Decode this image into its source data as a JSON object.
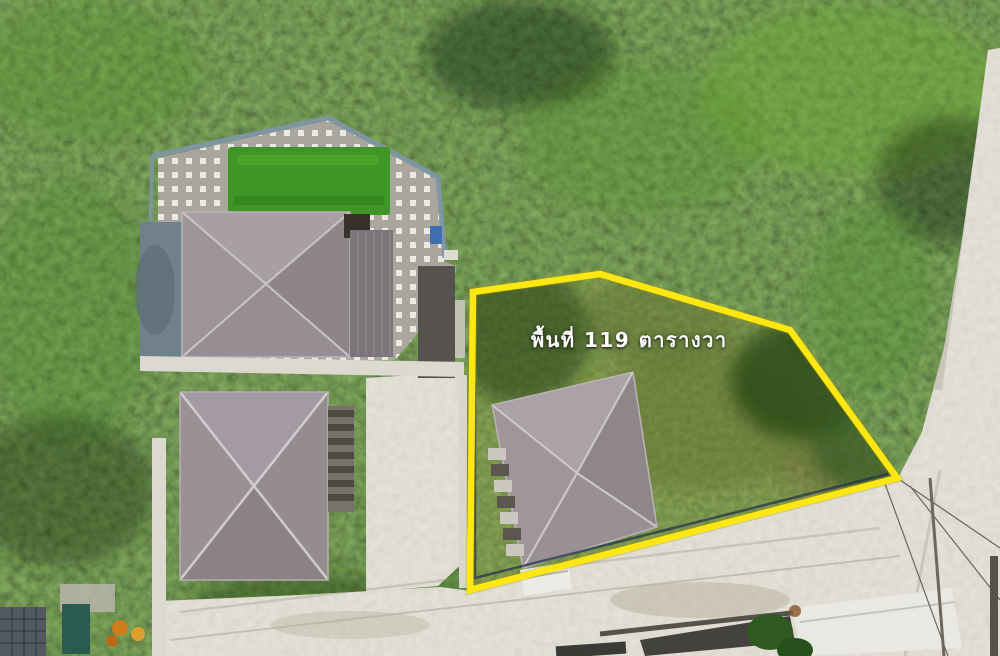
{
  "annotation": {
    "area_label": "พื้นที่ 119 ตารางวา",
    "text_color": "#ffffff"
  },
  "plot_boundary": {
    "points": "600,274 790,330 897,478 470,590 473,292",
    "color": "#ffe713",
    "stroke_width": "6.5"
  },
  "colors": {
    "vegetation_base": "#2f4e1d",
    "plot_grass": "#3f561c",
    "road_concrete": "#c9c5b7",
    "turf_green": "#3f9626",
    "patio_tile": "#a9a69e",
    "roof_main": "#9a9095",
    "wall_white": "#dcd9d0"
  }
}
